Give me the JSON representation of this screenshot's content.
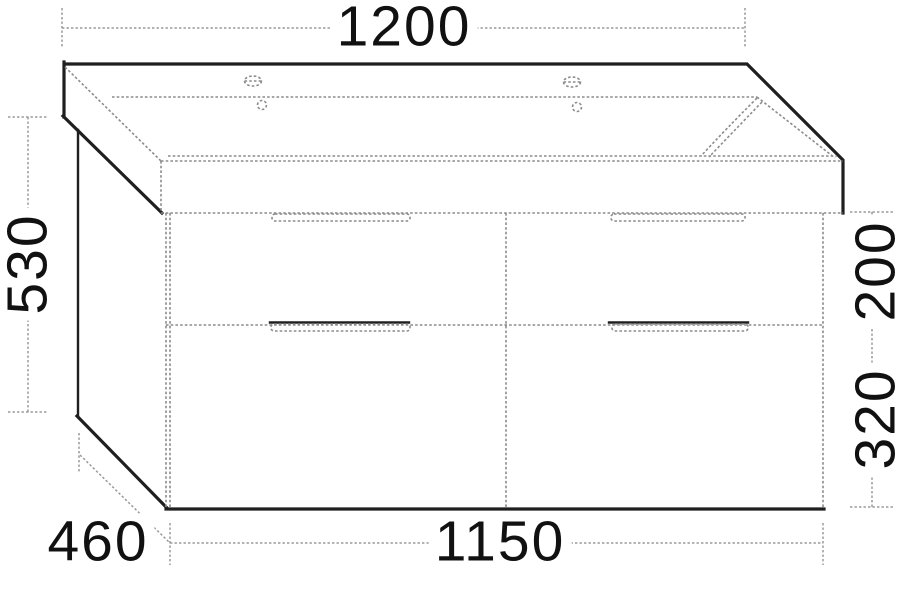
{
  "diagram": {
    "kind": "technical-drawing",
    "dimensions": {
      "top_width": "1200",
      "left_height": "530",
      "right_upper_height": "200",
      "right_lower_height": "320",
      "depth": "460",
      "bottom_width": "1150"
    },
    "colors": {
      "bg": "#ffffff",
      "outline": "#1f1f1f",
      "hidden": "#8c8c8c",
      "dimension": "#9a9a9a",
      "text": "#111111"
    }
  }
}
